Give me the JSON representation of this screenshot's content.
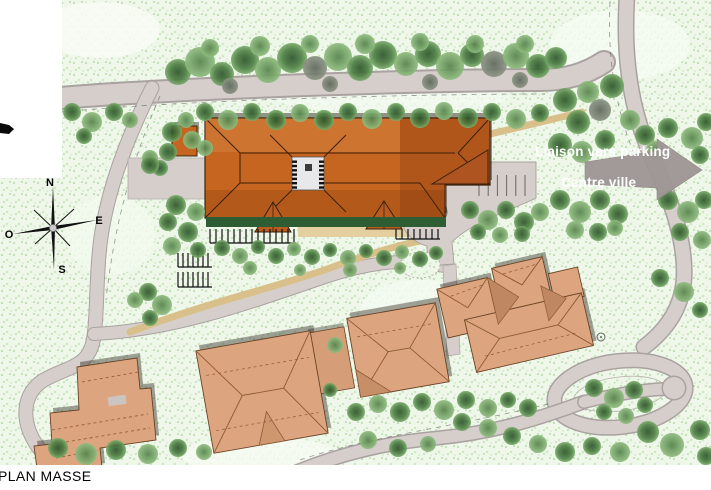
{
  "title": {
    "label": "PLAN MASSE"
  },
  "map_labels": {
    "liaison_vers_parking": "Liaison vers parking",
    "centre_ville": "Centre ville"
  },
  "compass": {
    "north": "N",
    "east": "E",
    "west": "O",
    "south": "S"
  },
  "colors": {
    "main_roof": "#c5651f",
    "main_roof_shade": "#b95c22",
    "lower_roofs": "#dca57f",
    "road": "#d5cecb",
    "grass_base": "#eff7ea",
    "tree_green": "#4c7c43",
    "hedge_green": "#2f5d33",
    "tan_path": "#d9c08a",
    "terrace_beige": "#ddc391",
    "direction_arrow": "#9e9694",
    "label_text": "#ffffff",
    "title_text": "#000000"
  }
}
